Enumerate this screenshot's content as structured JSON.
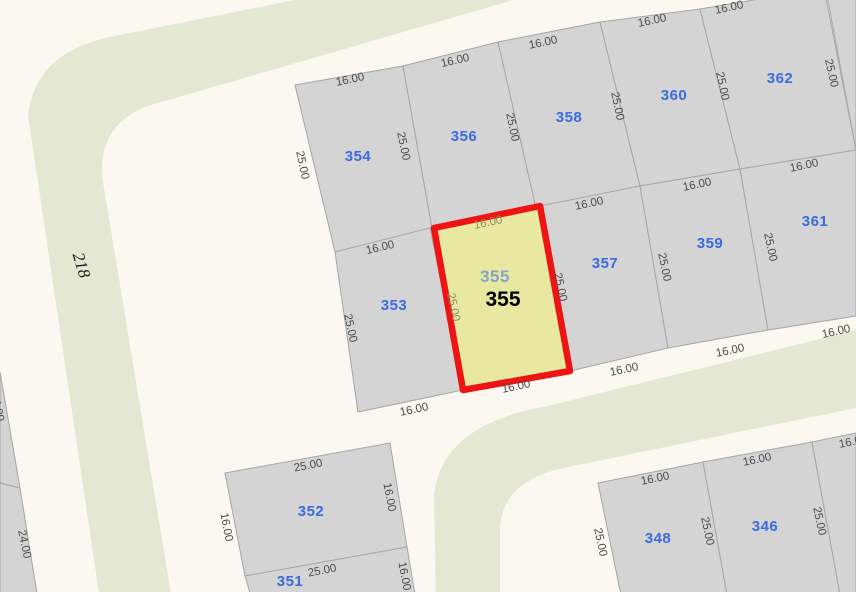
{
  "map": {
    "width": 856,
    "height": 592,
    "colors": {
      "background": "#faf8f0",
      "street": "#e4e7d2",
      "parcel_fill": "#d4d4d4",
      "parcel_stroke": "#a6a6a6",
      "selected_fill": "#e9e8a0",
      "selected_stroke": "#ee1414",
      "parcel_number": "#3a6be0",
      "dimension_text": "#4b4b4b",
      "inner_dimension_text": "#8b8b60",
      "selected_sub_number": "#82a5c9",
      "selected_main_number": "#000000",
      "street_label_text": "#1a1a1a"
    },
    "streets": [
      {
        "name": "street-218-band",
        "path": "M 345,-10 L 105,38 Q 35,55 28,115 L 100,600 L 172,600 L 103,182 Q 95,120 158,103 L 548,-10 Z"
      },
      {
        "name": "street-bottom-band",
        "path": "M 856,330 L 548,406 Q 442,424 434,495 L 436,600 L 500,600 L 500,528 Q 502,480 568,467 L 856,408 Z"
      }
    ],
    "street_label": {
      "text": "218",
      "x": 82,
      "y": 265,
      "rotation": 73
    },
    "parcels": [
      {
        "id": "354",
        "points": "295,85 403,66 432,228 335,252",
        "label": "354",
        "label_x": 358,
        "label_y": 156
      },
      {
        "id": "356",
        "points": "403,66 498,42 536,208 432,228",
        "label": "356",
        "label_x": 464,
        "label_y": 136
      },
      {
        "id": "358",
        "points": "498,42 600,22 640,186 536,208",
        "label": "358",
        "label_x": 569,
        "label_y": 117
      },
      {
        "id": "360",
        "points": "600,22 700,9 740,169 640,186",
        "label": "360",
        "label_x": 674,
        "label_y": 95
      },
      {
        "id": "362",
        "points": "700,9 824,-12 856,150 740,169",
        "label": "362",
        "label_x": 780,
        "label_y": 78
      },
      {
        "id": "ne-corner",
        "points": "826,-10 856,-10 856,150"
      },
      {
        "id": "353",
        "points": "335,252 430,228 463,390 358,412",
        "label": "353",
        "label_x": 394,
        "label_y": 305
      },
      {
        "id": "357",
        "points": "540,206 640,186 668,348 570,371",
        "label": "357",
        "label_x": 605,
        "label_y": 263
      },
      {
        "id": "359",
        "points": "640,186 740,169 768,330 668,348",
        "label": "359",
        "label_x": 710,
        "label_y": 243
      },
      {
        "id": "361",
        "points": "740,169 856,150 856,316 768,330",
        "label": "361",
        "label_x": 815,
        "label_y": 221
      },
      {
        "id": "352",
        "points": "225,473 390,443 407,547 245,576",
        "label": "352",
        "label_x": 311,
        "label_y": 511
      },
      {
        "id": "351",
        "points": "245,576 407,547 416,600 252,600",
        "label": "351",
        "label_x": 290,
        "label_y": 581
      },
      {
        "id": "348",
        "points": "598,483 703,462 728,600 622,600",
        "label": "348",
        "label_x": 658,
        "label_y": 538
      },
      {
        "id": "346",
        "points": "703,462 812,442 841,600 728,600",
        "label": "346",
        "label_x": 765,
        "label_y": 526
      },
      {
        "id": "se-corner",
        "points": "812,442 856,433 856,600 841,600"
      },
      {
        "id": "w-wedge-upper",
        "points": "0,372 20,488 0,483"
      },
      {
        "id": "w-wedge-lower",
        "points": "0,483 20,488 38,600 0,600"
      }
    ],
    "selected_parcel": {
      "id": "355",
      "points": "434,228 540,206 570,371 463,390",
      "labels": [
        {
          "text": "355",
          "x": 495,
          "y": 276,
          "style": "sub"
        },
        {
          "text": "355",
          "x": 503,
          "y": 299,
          "style": "main"
        }
      ]
    },
    "dimension_labels": [
      {
        "text": "16.00",
        "x": 350,
        "y": 79,
        "rot": -12
      },
      {
        "text": "16.00",
        "x": 455,
        "y": 60,
        "rot": -13
      },
      {
        "text": "16.00",
        "x": 543,
        "y": 42,
        "rot": -12
      },
      {
        "text": "16.00",
        "x": 652,
        "y": 20,
        "rot": -12
      },
      {
        "text": "16.00",
        "x": 729,
        "y": 7,
        "rot": -12
      },
      {
        "text": "25.00",
        "x": 303,
        "y": 165,
        "rot": 78
      },
      {
        "text": "25.00",
        "x": 404,
        "y": 146,
        "rot": 78
      },
      {
        "text": "25.00",
        "x": 513,
        "y": 127,
        "rot": 78
      },
      {
        "text": "25.00",
        "x": 618,
        "y": 106,
        "rot": 78
      },
      {
        "text": "25.00",
        "x": 723,
        "y": 86,
        "rot": 78
      },
      {
        "text": "25.00",
        "x": 832,
        "y": 73,
        "rot": 77
      },
      {
        "text": "16.00",
        "x": 380,
        "y": 247,
        "rot": -13
      },
      {
        "text": "16.00",
        "x": 589,
        "y": 203,
        "rot": -12
      },
      {
        "text": "16.00",
        "x": 697,
        "y": 184,
        "rot": -12
      },
      {
        "text": "16.00",
        "x": 804,
        "y": 165,
        "rot": -12
      },
      {
        "text": "16.00",
        "x": 488,
        "y": 222,
        "rot": -12,
        "inner": true
      },
      {
        "text": "25.00",
        "x": 351,
        "y": 328,
        "rot": 78
      },
      {
        "text": "25.00",
        "x": 454,
        "y": 307,
        "rot": 78,
        "inner": true
      },
      {
        "text": "25.00",
        "x": 561,
        "y": 287,
        "rot": 78
      },
      {
        "text": "25.00",
        "x": 665,
        "y": 267,
        "rot": 78
      },
      {
        "text": "25.00",
        "x": 771,
        "y": 247,
        "rot": 78
      },
      {
        "text": "16.00",
        "x": 414,
        "y": 409,
        "rot": -12
      },
      {
        "text": "16.00",
        "x": 516,
        "y": 386,
        "rot": -12
      },
      {
        "text": "16.00",
        "x": 624,
        "y": 369,
        "rot": -12
      },
      {
        "text": "16.00",
        "x": 730,
        "y": 350,
        "rot": -12
      },
      {
        "text": "16.00",
        "x": 836,
        "y": 331,
        "rot": -13
      },
      {
        "text": "25.00",
        "x": 308,
        "y": 465,
        "rot": -11
      },
      {
        "text": "16.00",
        "x": 227,
        "y": 527,
        "rot": 79
      },
      {
        "text": "16.00",
        "x": 390,
        "y": 497,
        "rot": 79
      },
      {
        "text": "25.00",
        "x": 322,
        "y": 570,
        "rot": -11
      },
      {
        "text": "16.00",
        "x": 405,
        "y": 576,
        "rot": 79
      },
      {
        "text": "16.00",
        "x": 655,
        "y": 478,
        "rot": -12
      },
      {
        "text": "16.00",
        "x": 757,
        "y": 459,
        "rot": -12
      },
      {
        "text": "16.00",
        "x": 853,
        "y": 441,
        "rot": -12
      },
      {
        "text": "25.00",
        "x": 601,
        "y": 542,
        "rot": 78
      },
      {
        "text": "25.00",
        "x": 708,
        "y": 531,
        "rot": 78
      },
      {
        "text": "25.00",
        "x": 820,
        "y": 521,
        "rot": 78
      },
      {
        "text": "24.00",
        "x": -2,
        "y": 407,
        "rot": 78
      },
      {
        "text": "24.00",
        "x": 25,
        "y": 544,
        "rot": 78
      }
    ]
  }
}
